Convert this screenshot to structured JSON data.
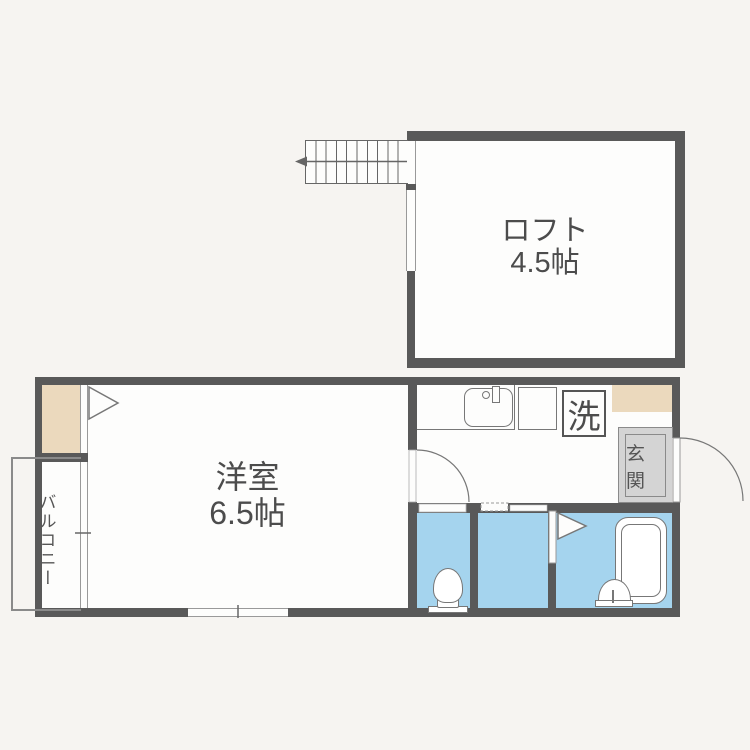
{
  "plan_type": "apartment-floor-plan",
  "rooms": {
    "loft": {
      "name": "ロフト",
      "area": "4.5帖"
    },
    "western": {
      "name": "洋室",
      "area": "6.5帖"
    },
    "balcony": {
      "name": "バルコニー"
    },
    "entrance": {
      "name": "玄関"
    },
    "laundry": {
      "name": "洗"
    }
  },
  "colors": {
    "wall": "#595959",
    "wet_area_blue": "#a5d4ee",
    "closet_tan": "#ebd9bd",
    "entrance_gray": "#d4d4d4",
    "floor_white": "#fdfdfc",
    "background": "#f6f4f1"
  }
}
